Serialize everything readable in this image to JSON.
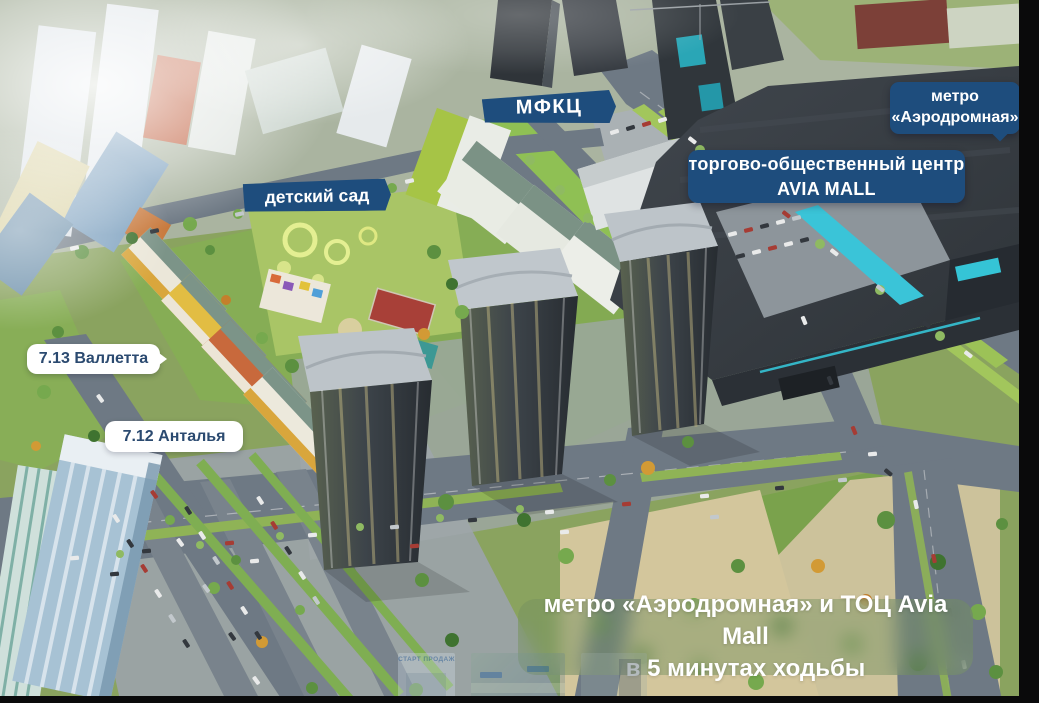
{
  "colors": {
    "label_blue": "#1e4d7d",
    "label_text_white": "#ffffff",
    "plaque_white": "#ffffff",
    "plaque_text_navy": "#2b4a70",
    "banner_overlay_green": "rgba(116,144,96,0.45)",
    "mall_accent_cyan": "#3ac4d8"
  },
  "labels": {
    "mfkc": {
      "text": "МФКЦ"
    },
    "metro": {
      "line1": "метро",
      "line2": "«Аэродромная»"
    },
    "mall": {
      "line1": "торгово-общественный центр",
      "line2": "AVIA MALL"
    },
    "kindergarten": {
      "text": "детский сад"
    },
    "plaque_713": {
      "text": "7.13 Валлетта"
    },
    "plaque_712": {
      "text": "7.12 Анталья"
    },
    "banner": {
      "line1": "метро «Аэродромная» и ТОЦ Avia Mall",
      "line2": "в 5 минутах ходьбы"
    },
    "thumbnail_caption": {
      "text": "СТАРТ ПРОДАЖ"
    }
  }
}
